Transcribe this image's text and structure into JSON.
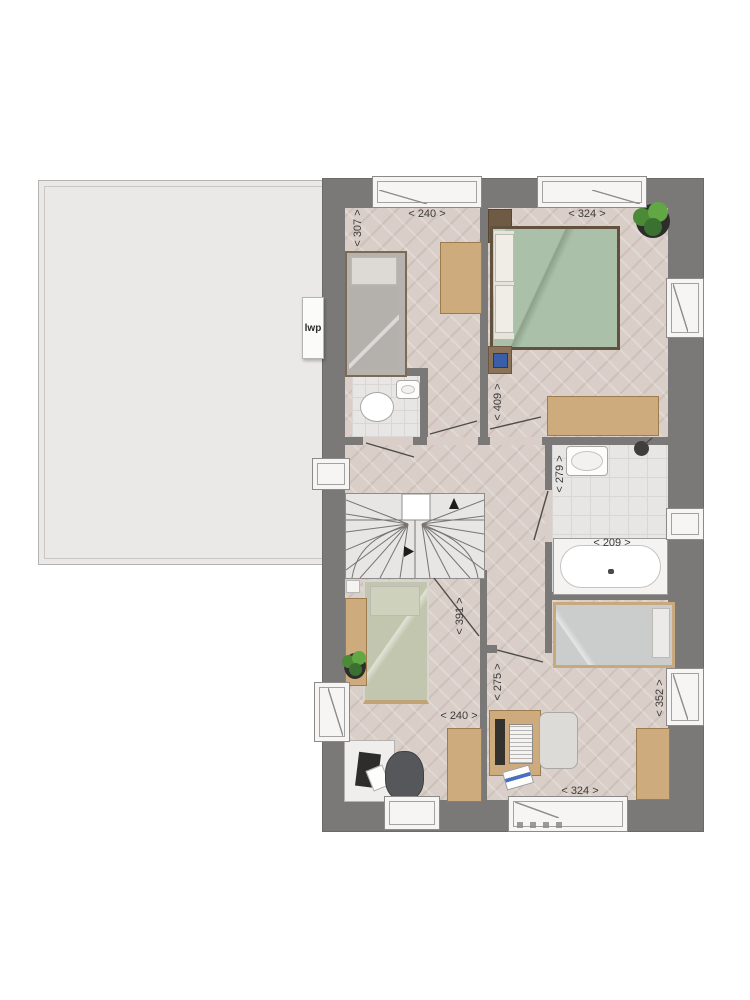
{
  "plan": {
    "unit_label": "lwp",
    "dimensions": {
      "bedroom1_width": "< 240 >",
      "bedroom1_depth": "< 307 >",
      "master_width": "< 324 >",
      "master_depth": "< 409 >",
      "bathroom_depth": "< 279 >",
      "bathroom_width": "< 209 >",
      "landing_depth": "< 391 >",
      "bedroom3_width": "< 240 >",
      "bedroom4_left_depth": "< 275 >",
      "bedroom4_width": "< 324 >",
      "bedroom4_depth": "< 352 >"
    },
    "colors": {
      "wall": "#7a7977",
      "parquet_floor": "#d9cec8",
      "tile_floor": "#e7e6e4",
      "flat_roof": "#eae9e7",
      "wood_furniture": "#cdab7c",
      "bedding_green": "#abc0a8",
      "plant_green": "#4c8a38"
    }
  }
}
